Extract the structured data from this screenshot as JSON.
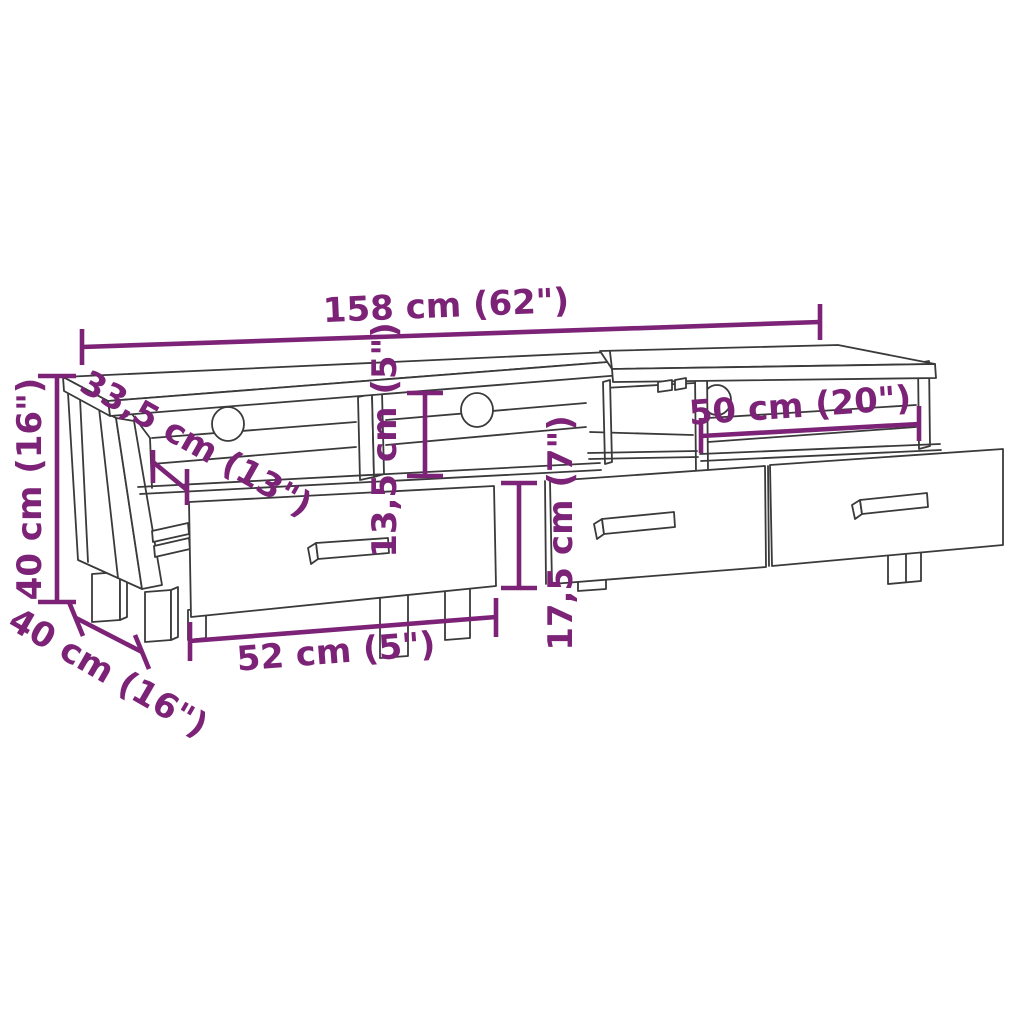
{
  "diagram": {
    "subject": "tv-cabinet-line-drawing",
    "style": {
      "accent_color": "#7c2377",
      "line_color": "#3a3a3a",
      "background_color": "#ffffff"
    },
    "labels": {
      "total_width": "158 cm (62\")",
      "height": "40 cm (16\")",
      "top_depth": "33,5 cm (13\")",
      "compartment_height": "13,5 cm (5\")",
      "drawer_height": "17,5 cm (7\")",
      "right_compartment_width": "50 cm (20\")",
      "drawer_width": "52 cm (5\")",
      "depth": "40 cm (16\")"
    }
  }
}
